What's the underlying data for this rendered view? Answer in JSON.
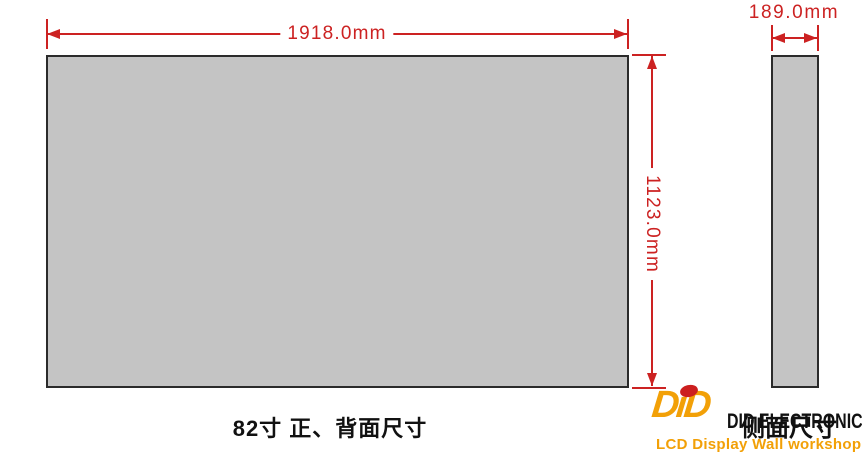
{
  "diagram": {
    "front_view": {
      "width_label": "1918.0mm",
      "height_label": "1123.0mm",
      "caption": "82寸 正、背面尺寸"
    },
    "side_view": {
      "width_label": "189.0mm",
      "caption": "侧面尺寸"
    }
  },
  "branding": {
    "logo_mark": "DiD",
    "company": "DID ELECTRONICS",
    "tagline": "LCD Display Wall workshop"
  },
  "colors": {
    "dimension_red": "#cc2222",
    "panel_fill": "#c4c4c4",
    "panel_border": "#2b2b2b",
    "brand_orange": "#f2a007",
    "brand_red": "#cc1f1f",
    "text_black": "#111111",
    "background": "#ffffff"
  }
}
